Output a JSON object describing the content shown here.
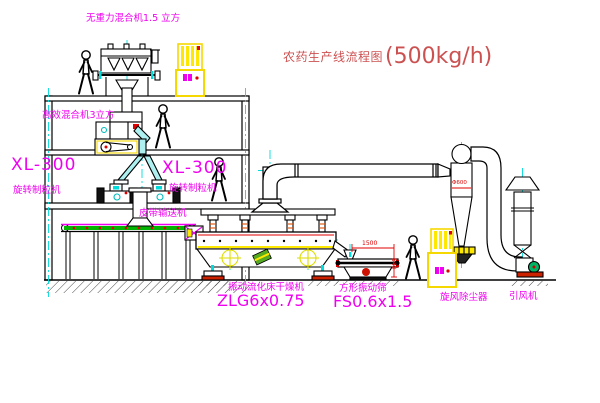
{
  "title": {
    "name": "农药生产线流程图",
    "capacity": "(500kg/h)"
  },
  "equipment_labels": {
    "gravity_free_mixer": "无重力混合机1.5 立方",
    "high_efficiency_mixer": "高效混合机3立方",
    "granulator_left_model": "XL-300",
    "granulator_left_name": "旋转制粒机",
    "granulator_right_model": "XL-300",
    "granulator_right_name": "旋转制粒机",
    "belt_conveyor": "皮带输送机",
    "fluid_bed_dryer_name": "振动流化床干燥机",
    "fluid_bed_dryer_model": "ZLG6x0.75",
    "vibrating_sieve_name": "方形振动筛",
    "vibrating_sieve_model": "FS0.6x1.5",
    "cyclone_dust_collector": "旋风除尘器",
    "induced_draft_fan": "引风机"
  },
  "dimensions": {
    "sieve_width": "1500",
    "sieve_height": "540",
    "cyclone_diameter": "Φ600"
  },
  "colors": {
    "drawing_line": "#000000",
    "centerline_cyan": "#00dcdc",
    "label_magenta": "#f000f0",
    "title_red": "#cc5252",
    "dimension_red": "#e00000",
    "cabinet_yellow": "#f5d800",
    "belt_green": "#00b400",
    "motor_green": "#00b464",
    "base_red": "#cc2200"
  }
}
